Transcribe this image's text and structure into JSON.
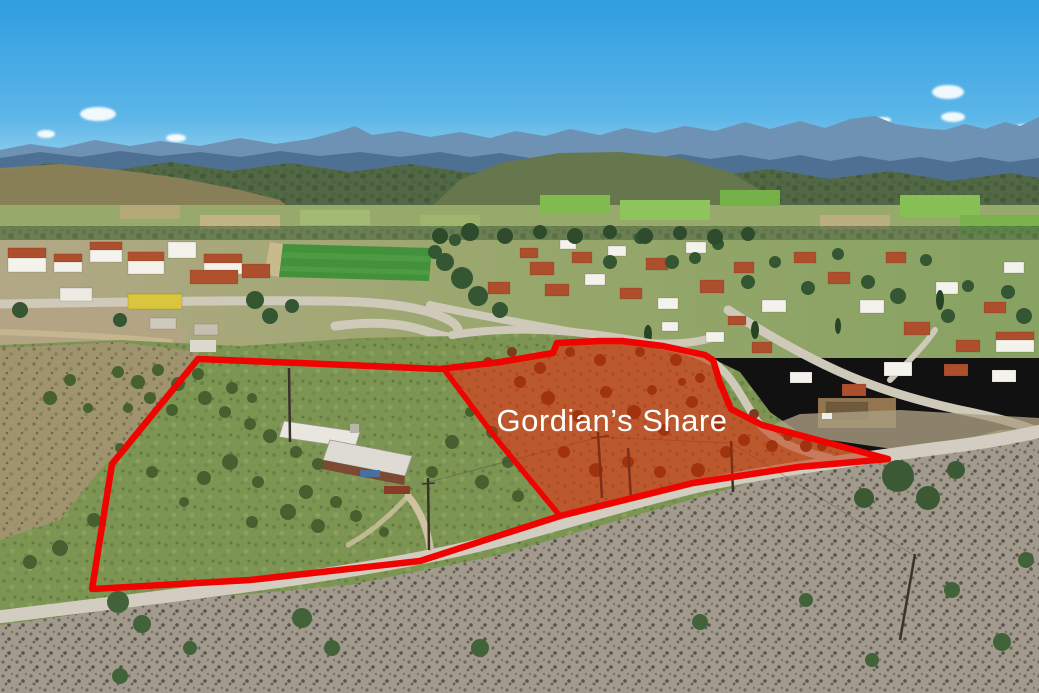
{
  "scene": {
    "type_label": "aerial-drone-photo",
    "label": "Gordian’s Share",
    "label_color": "#ffffff",
    "boundary_color": "#ee0400",
    "parcel_fill_color": "#c42c00",
    "parcel_fill_opacity": "0.50",
    "sky_color_top": "#2f9ddf",
    "sky_color_mid": "#5cb6e8",
    "sky_color_horizon": "#a6d7ef",
    "outline_points": "198,359 300,363 440,369 500,362 553,353 557,343 600,341 622,341 663,346 705,355 713,360 720,383 731,409 762,425 888,459 798,467 693,483 560,516 420,561 250,580 92,589 112,464",
    "right_parcel_points": "443,368 500,362 553,353 557,343 600,341 622,341 663,346 705,355 713,360 720,383 731,409 762,425 888,459 798,467 693,483 560,516 498,441",
    "divider_points": "443,368 498,441 560,516"
  }
}
